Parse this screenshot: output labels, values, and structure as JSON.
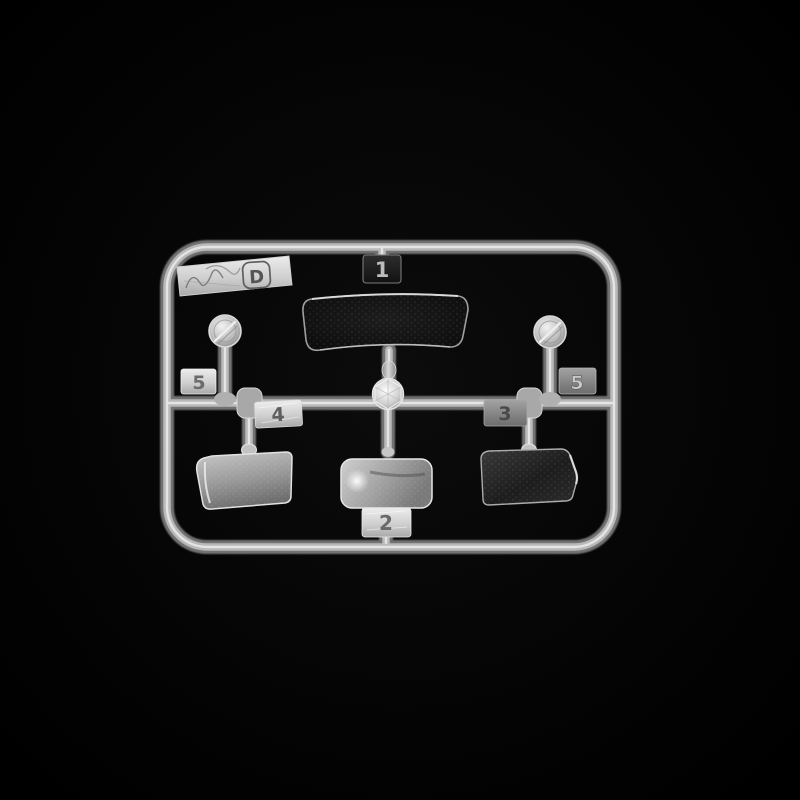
{
  "photo": {
    "subject": "clear plastic model kit sprue on black background",
    "sprue_letter": "D",
    "tags": {
      "windshield": "1",
      "rear_window": "2",
      "right_side_window": "3",
      "left_side_window": "4",
      "left_round_lens": "5",
      "right_round_lens": "5"
    },
    "colors": {
      "background": "#000000",
      "rail_base": "#858585",
      "rail_core": "#bdbdbd",
      "rail_specular": "#e8e8e8",
      "clear_part_dark": "#101010",
      "clear_part_bright": "#b8b8b8",
      "tab_bright": "#dedede",
      "tab_mid": "#8c8c8c",
      "tab_dark": "#1c1c1c"
    }
  }
}
